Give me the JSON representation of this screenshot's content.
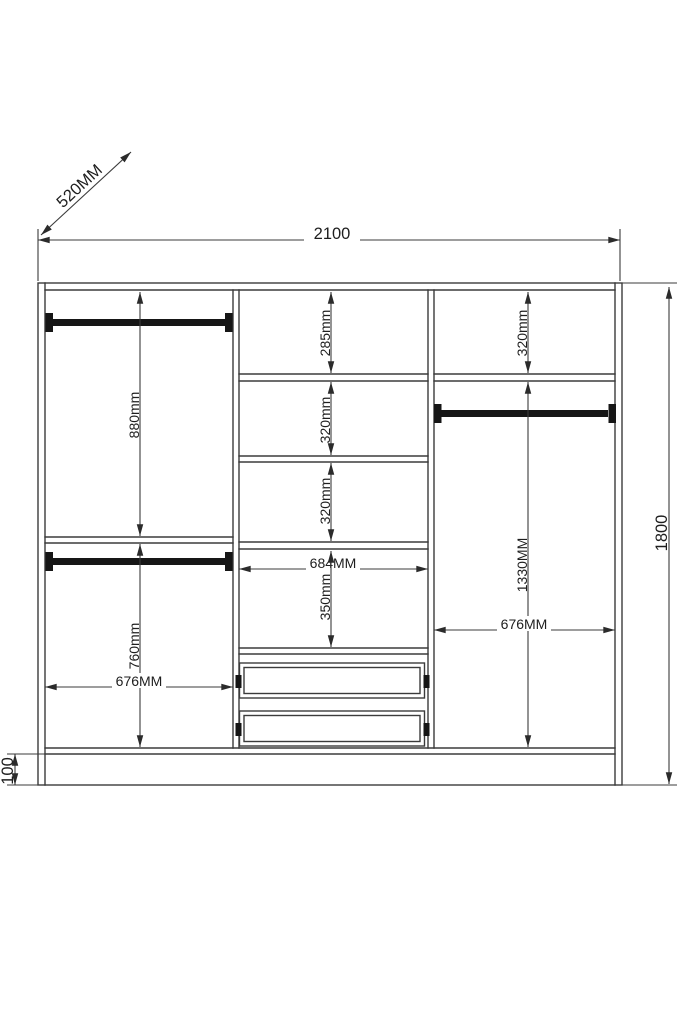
{
  "dimensions": {
    "overall": {
      "depth": "520MM",
      "width": "2100",
      "height": "1800",
      "plinth_height": "100"
    },
    "left_section": {
      "upper_height": "880mm",
      "lower_height": "760mm",
      "width": "676MM"
    },
    "middle_section": {
      "shelf1_height": "285mm",
      "shelf2_height": "320mm",
      "shelf3_height": "320mm",
      "width": "684MM",
      "shelf4_height": "350mm"
    },
    "right_section": {
      "top_height": "320mm",
      "hanging_height": "1330MM",
      "width": "676MM"
    }
  },
  "colors": {
    "background": "#ffffff",
    "line": "#3b3b3b",
    "rail_fill": "#161616",
    "text": "#1e1e1e"
  }
}
